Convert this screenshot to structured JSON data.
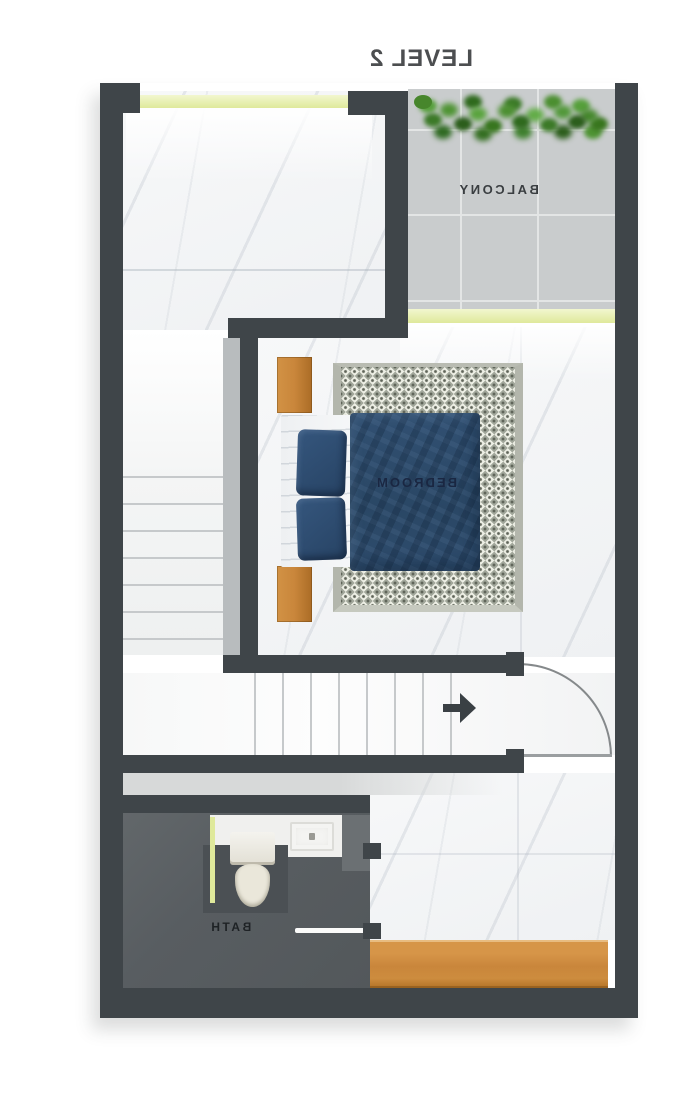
{
  "title": "LEVEL 2",
  "rooms": {
    "balcony": {
      "label": "BALCONY"
    },
    "bedroom": {
      "label": "BEDROOM"
    },
    "bath": {
      "label": "BATH"
    }
  },
  "icons": {
    "entry_arrow": "arrow-right-icon",
    "plants": "plant-hedge-icon"
  },
  "palette": {
    "wall": "#3f4549",
    "halfwall": "#b8bcbe",
    "balconyTile": "#c9cccd",
    "grout": "#e3e5e5",
    "bathFloor": "#585d61",
    "vanity": "#4b5054",
    "wood": "#c9863b",
    "glass": "#dfe99b",
    "duvet": "#2a4765",
    "pillow": "#274364",
    "rugBase": "#eceee4",
    "rugPattern": "#a3a89c",
    "rugDot": "#5f6459",
    "plant1": "#3c7a28",
    "plant2": "#47862c",
    "plant3": "#2c5e1c",
    "arrow": "#3a4044",
    "doorArc": "#85898b",
    "titleColor": "#4c4e50",
    "labelDark": "#3a3e41",
    "bedroomLabel": "#1a2742",
    "bathLabel": "#1e2225"
  }
}
